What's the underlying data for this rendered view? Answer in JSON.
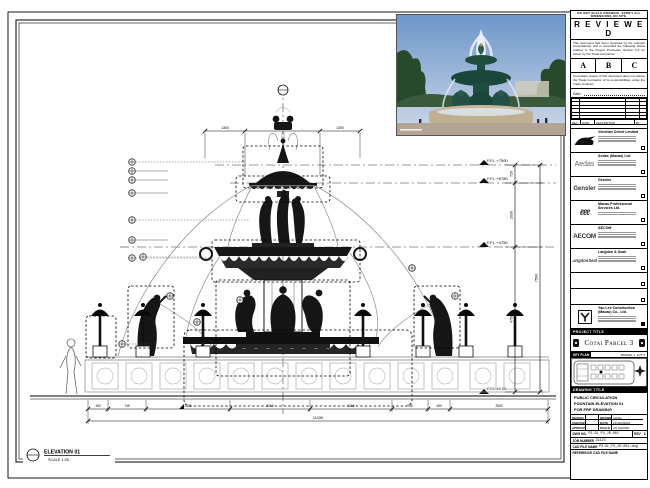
{
  "disclaimer": "DO NOT SCALE DRAWING. VERIFY ALL DIMENSIONS ON SITE.",
  "stamp": {
    "title": "R E V I E W E D",
    "body1": "This document has been reviewed by the relevant Consultant(s) and is accorded the following status relative to the Project Procedure Section 5.4 for action by the Trade Contractor.",
    "options": [
      "A",
      "B",
      "C"
    ],
    "body2": "Consultant review of this document does not relieve the Trade Contractor of its responsibilities under the Trade Contract.",
    "date_label": "Date :"
  },
  "revisions": {
    "headers": [
      "REV",
      "DATE",
      "DESCRIPTION",
      "BY"
    ]
  },
  "consultants": [
    {
      "name": "Venetian Orient Limited"
    },
    {
      "name": "Aedas (Macau) Ltd.",
      "logo_text": "Aedas"
    },
    {
      "name": "Gensler",
      "logo_text": "Gensler"
    },
    {
      "name": "Macau Professional Services Ltd.",
      "logo_text": "ℓℓℓ"
    },
    {
      "name": "AECOM",
      "logo_text": "AECOM"
    },
    {
      "name": "Langdon & Seah",
      "logo_text": "LangdonSeah"
    }
  ],
  "contractor": {
    "name": "Yau Lee Construction (Macau) Co., Ltd.",
    "logo_text": "Y"
  },
  "project": {
    "header": "PROJECT TITLE",
    "title": "Cotai Parcel 3"
  },
  "key_plan": {
    "header": "KEY PLAN",
    "note": "PARCEL 1, LOT 2"
  },
  "drawing": {
    "header": "DRAWING TITLE",
    "line1": "PUBLIC CIRCULATION",
    "line2": "FOUNTAIN ELEVATION 01",
    "line3": "FOR FRP DRAWING"
  },
  "credits": {
    "design_label": "DESIGN",
    "design": "-",
    "drawn_label": "DRAWN",
    "drawn": "CHAD",
    "checked_label": "CHECKED",
    "checked": "-",
    "date_label": "DATE",
    "date": "13/JAN/2016",
    "approved_label": "APPROVED",
    "approved": "-",
    "scale_label": "SCALE",
    "scale": "AS SHOWN"
  },
  "doc": {
    "dwg_label": "DWG NO.",
    "dwg_no": "P3-GL_FO_JR-001",
    "rev_label": "REV",
    "rev": "0",
    "job_label": "JOB NUMBER",
    "job_no": "31123",
    "cad_label": "CAD FILE NAME",
    "cad_file": "P3-GL_FO_JR-001.dwg",
    "ref_label": "REFERENCE CAD FILE NAME"
  },
  "view": {
    "title": "ELEVATION 01",
    "scale": "SCALE 1:25"
  },
  "levels": [
    {
      "label": "F.F.L +7500"
    },
    {
      "label": "F.F.L +6780"
    },
    {
      "label": "F.F.L +4750"
    },
    {
      "label": "F.F.L ±0.00"
    }
  ],
  "dims": {
    "top": [
      "1300",
      "2400",
      "1300"
    ],
    "right": [
      "720",
      "2030",
      "4750"
    ],
    "right_overall": "7500",
    "bottom": [
      "450",
      "745",
      "2115",
      "2210",
      "2115",
      "745",
      "450",
      "2500"
    ],
    "bottom_overall": "11330"
  },
  "colors": {
    "sky": "#7d9fcb",
    "patina": "#1e4d40",
    "stone": "#c8b89a",
    "ink": "#000000"
  }
}
